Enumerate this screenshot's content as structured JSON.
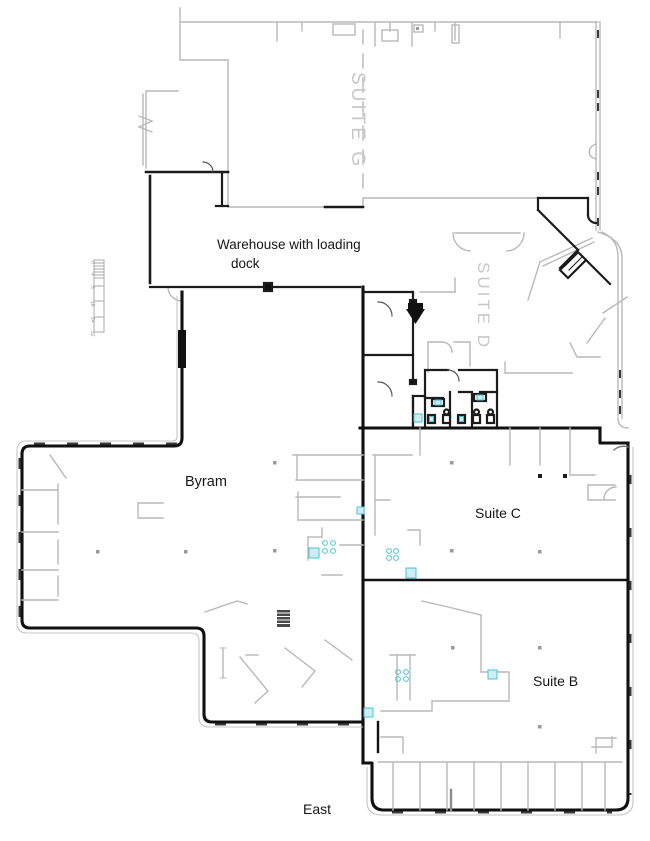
{
  "floorplan": {
    "labels": {
      "suite_g": "SUITE G",
      "suite_d": "SUITE D",
      "warehouse_line1": "Warehouse with loading",
      "warehouse_line2": "dock",
      "byram": "Byram",
      "suite_c": "Suite C",
      "suite_b": "Suite B",
      "east": "East"
    },
    "scale_bar": {
      "ticks": [
        "0",
        "4",
        "8",
        "16",
        "24",
        "32"
      ]
    },
    "colors": {
      "wall_dark": "#1c1c1c",
      "wall_light": "#b9b9b9",
      "suite_text": "#c8c8c8",
      "fixture_fill": "#cdeef4",
      "fixture_stroke": "#49c3d2"
    }
  }
}
